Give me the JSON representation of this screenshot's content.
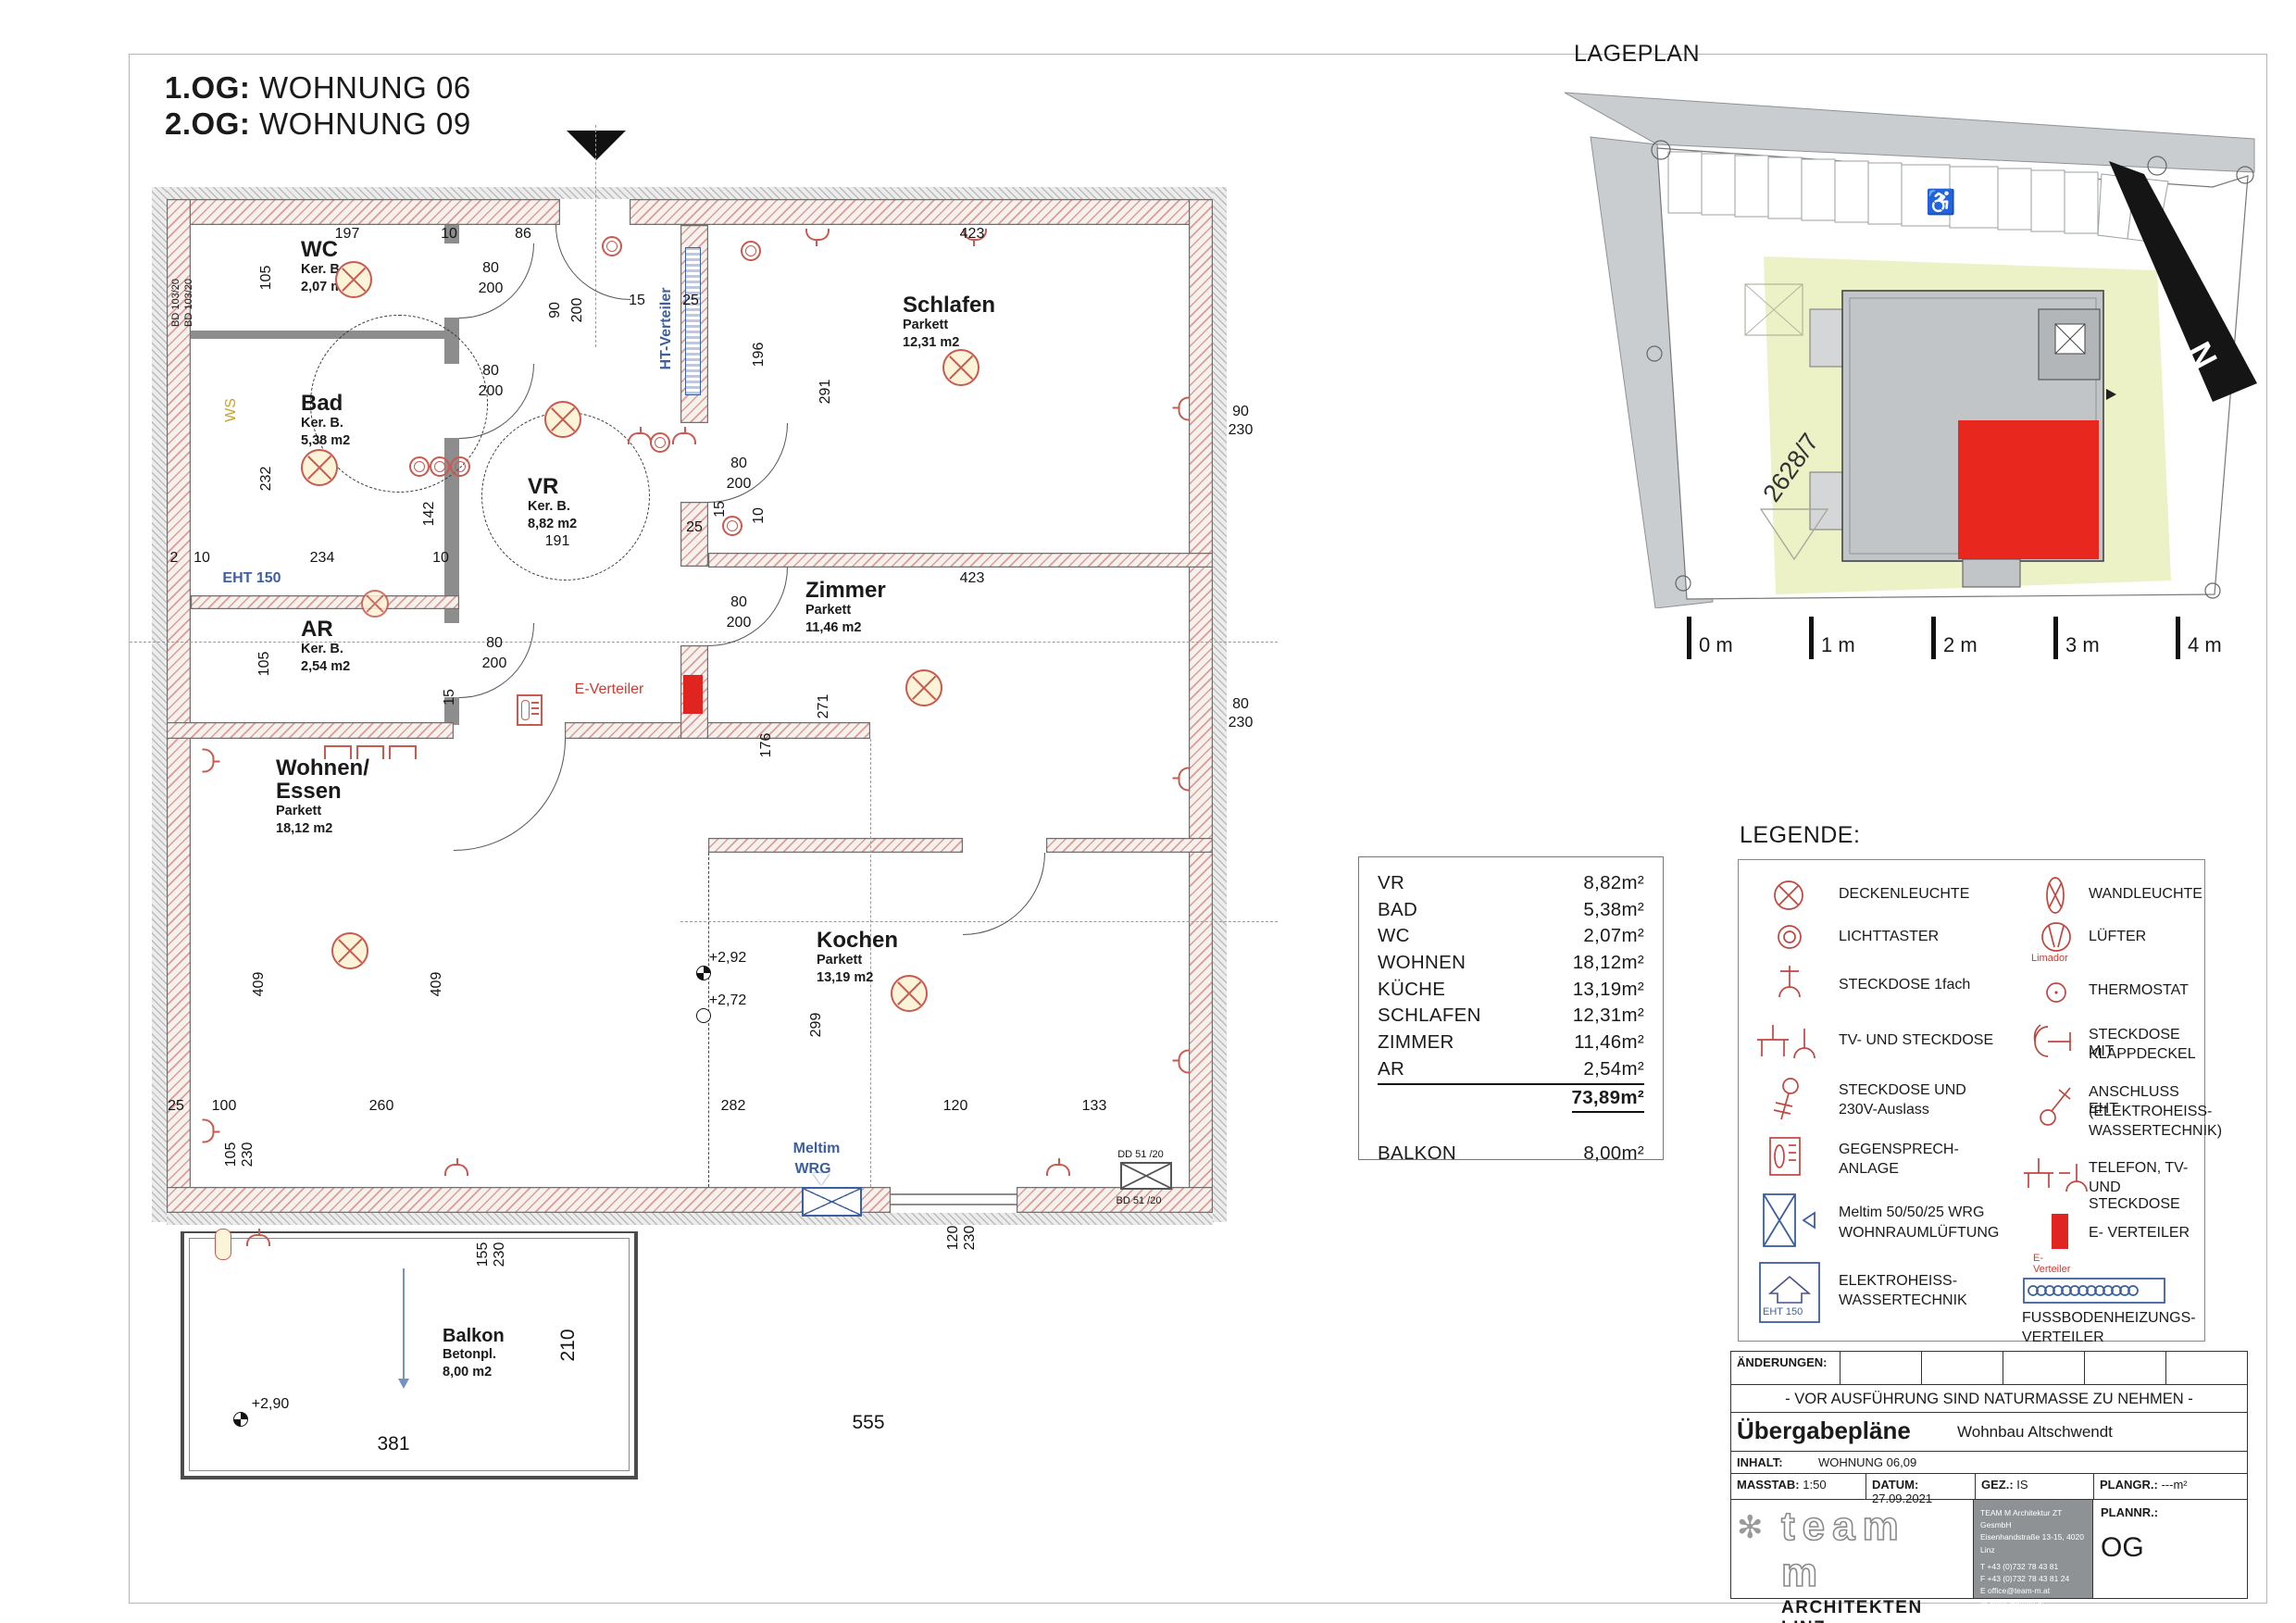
{
  "title": {
    "line1_label": "1.OG:",
    "line1_value": "WOHNUNG 06",
    "line2_label": "2.OG:",
    "line2_value": "WOHNUNG 09"
  },
  "plan": {
    "rooms": {
      "wc": {
        "name": "WC",
        "material": "Ker. B.",
        "area": "2,07 m2"
      },
      "bad": {
        "name": "Bad",
        "material": "Ker. B.",
        "area": "5,38 m2"
      },
      "vr": {
        "name": "VR",
        "material": "Ker. B.",
        "area": "8,82 m2"
      },
      "ar": {
        "name": "AR",
        "material": "Ker. B.",
        "area": "2,54 m2"
      },
      "wohnen": {
        "name": "Wohnen/",
        "name2": "Essen",
        "material": "Parkett",
        "area": "18,12 m2"
      },
      "schlafen": {
        "name": "Schlafen",
        "material": "Parkett",
        "area": "12,31 m2"
      },
      "zimmer": {
        "name": "Zimmer",
        "material": "Parkett",
        "area": "11,46 m2"
      },
      "kochen": {
        "name": "Kochen",
        "material": "Parkett",
        "area": "13,19 m2"
      },
      "balkon": {
        "name": "Balkon",
        "material": "Betonpl.",
        "area": "8,00 m2"
      }
    },
    "dims": {
      "d2": "2",
      "d10": "10",
      "d15": "15",
      "d25": "25",
      "d80": "80",
      "d86": "86",
      "d90": "90",
      "d100": "100",
      "d105": "105",
      "d120": "120",
      "d133": "133",
      "d142": "142",
      "d155": "155",
      "d176": "176",
      "d191": "191",
      "d196": "196",
      "d197": "197",
      "d200": "200",
      "d210": "210",
      "d230": "230",
      "d232": "232",
      "d234": "234",
      "d260": "260",
      "d271": "271",
      "d282": "282",
      "d291": "291",
      "d299": "299",
      "d381": "381",
      "d409": "409",
      "d423": "423",
      "d555": "555"
    },
    "levels": {
      "a": "+2,92",
      "b": "+2,72",
      "c": "+2,90"
    },
    "labels": {
      "ht": "HT-Verteiler",
      "ev": "E-Verteiler",
      "eht": "EHT 150",
      "meltim": "Meltim",
      "wrg": "WRG",
      "ws": "WS",
      "bd103": "BD 103/20",
      "dd51": "DD 51 /20",
      "bd51": "BD 51 /20"
    }
  },
  "lageplan": {
    "title": "LAGEPLAN",
    "parcel": "2628/7",
    "north": "N",
    "scale": [
      "0 m",
      "1 m",
      "2 m",
      "3 m",
      "4 m"
    ]
  },
  "area_table": {
    "rows": [
      {
        "label": "VR",
        "value": "8,82m²"
      },
      {
        "label": "BAD",
        "value": "5,38m²"
      },
      {
        "label": "WC",
        "value": "2,07m²"
      },
      {
        "label": "WOHNEN",
        "value": "18,12m²"
      },
      {
        "label": "KÜCHE",
        "value": "13,19m²"
      },
      {
        "label": "SCHLAFEN",
        "value": "12,31m²"
      },
      {
        "label": "ZIMMER",
        "value": "11,46m²"
      },
      {
        "label": "AR",
        "value": "2,54m²"
      }
    ],
    "total": "73,89m²",
    "balkon_label": "BALKON",
    "balkon_value": "8,00m²"
  },
  "legend": {
    "title": "LEGENDE:",
    "left": [
      {
        "label1": "DECKENLEUCHTE"
      },
      {
        "label1": "LICHTTASTER"
      },
      {
        "label1": "STECKDOSE 1fach"
      },
      {
        "label1": "TV- UND STECKDOSE"
      },
      {
        "label1": "STECKDOSE UND",
        "label2": "230V-Auslass"
      },
      {
        "label1": "GEGENSPRECH-",
        "label2": "ANLAGE"
      },
      {
        "label1": "Meltim 50/50/25  WRG",
        "label2": "WOHNRAUMLÜFTUNG"
      },
      {
        "label1": "ELEKTROHEISS-",
        "label2": "WASSERTECHNIK",
        "icon_label": "EHT 150"
      }
    ],
    "right": [
      {
        "label1": "WANDLEUCHTE"
      },
      {
        "label1": "LÜFTER",
        "icon_label": "Limador"
      },
      {
        "label1": "THERMOSTAT"
      },
      {
        "label1": "STECKDOSE MIT",
        "label2": "KLAPPDECKEL"
      },
      {
        "label1": "ANSCHLUSS EHT",
        "label2": "(ELEKTROHEISS-",
        "label3": "WASSERTECHNIK)"
      },
      {
        "label1": "TELEFON, TV-",
        "label2": "UND STECKDOSE"
      },
      {
        "label1": "E- VERTEILER",
        "icon_label": "E-Verteiler"
      },
      {
        "label1": "FUSSBODENHEIZUNGS-",
        "label2": "VERTEILER"
      }
    ]
  },
  "titleblock": {
    "aenderungen": "ÄNDERUNGEN:",
    "notice": "- VOR AUSFÜHRUNG SIND NATURMASSE ZU NEHMEN -",
    "doc_type": "Übergabepläne",
    "project": "Wohnbau Altschwendt",
    "inhalt_label": "INHALT:",
    "inhalt": "WOHNUNG 06,09",
    "masstab_label": "MASSTAB:",
    "masstab": "1:50",
    "datum_label": "DATUM:",
    "datum": "27.09.2021",
    "gez_label": "GEZ.:",
    "gez": "IS",
    "plangr_label": "PLANGR.:",
    "plangr": "---m²",
    "plannr_label": "PLANNR.:",
    "plannr": "OG",
    "logo_text": "team m",
    "firm_name": "ARCHITEKTEN LINZ",
    "tagline1": "Visionen werden Schönes werden. Wir planen sie.",
    "tagline2": "zeitgemäße Baukunst. Verantwortung für Zeit, Natur und Mensch.",
    "contact": {
      "l1": "TEAM M Architektur ZT GesmbH",
      "l2": "Eisenhandstraße 13-15, 4020 Linz",
      "l3": "T  +43 (0)732 78 43 81",
      "l4": "F  +43 (0)732 78 43 81 24",
      "l5": "E  office@team-m.at",
      "l6": "W  www.team-m.at"
    }
  }
}
